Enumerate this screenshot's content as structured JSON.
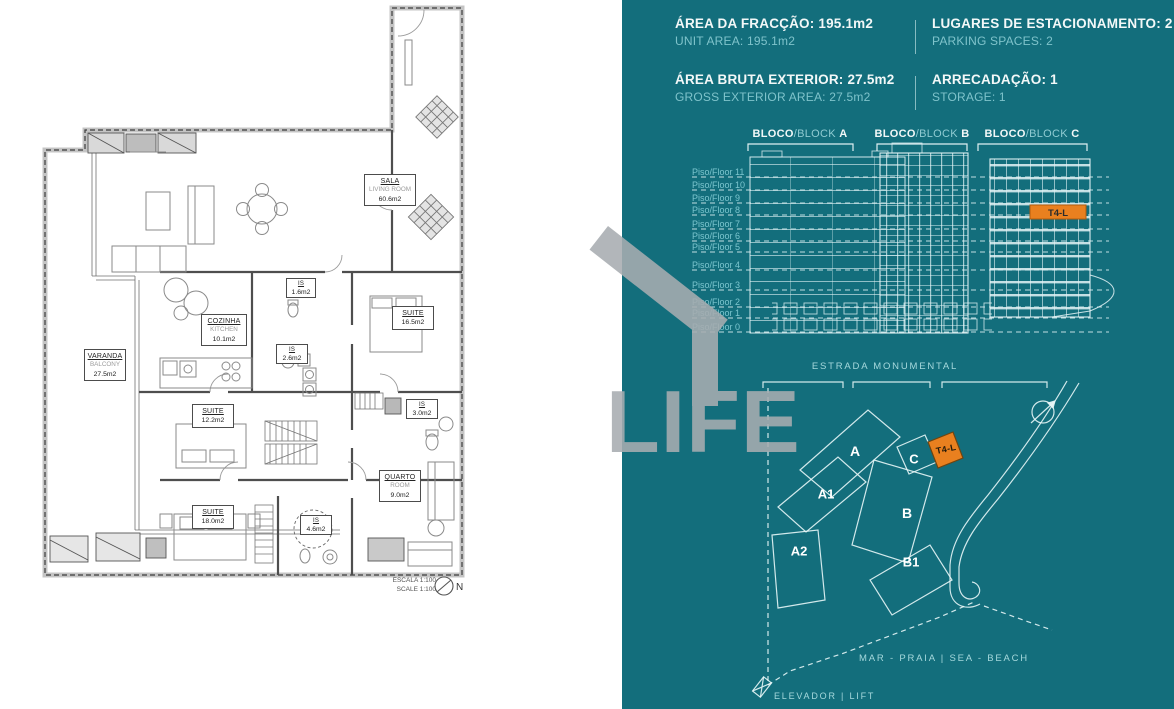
{
  "unit": "T4-L",
  "watermark": "LIFE",
  "colors": {
    "panel_teal": "#136e7c",
    "highlight_orange": "#e9801f",
    "watermark_gray": "#a8adb1",
    "line_light": "#dff0f2"
  },
  "header": {
    "col1": [
      {
        "pt": "ÁREA DA FRACÇÃO: 195.1m2",
        "en": "UNIT AREA: 195.1m2"
      },
      {
        "pt": "ÁREA BRUTA EXTERIOR: 27.5m2",
        "en": "GROSS EXTERIOR AREA: 27.5m2"
      }
    ],
    "col2": [
      {
        "pt": "LUGARES DE ESTACIONAMENTO: 2",
        "en": "PARKING SPACES: 2"
      },
      {
        "pt": "ARRECADAÇÃO: 1",
        "en": "STORAGE: 1"
      }
    ]
  },
  "elevation": {
    "blocks": [
      {
        "bold": "BLOCO",
        "light": "/BLOCK ",
        "letter": "A"
      },
      {
        "bold": "BLOCO",
        "light": "/BLOCK ",
        "letter": "B"
      },
      {
        "bold": "BLOCO",
        "light": "/BLOCK ",
        "letter": "C"
      }
    ],
    "floors": [
      "Piso/Floor 11",
      "Piso/Floor 10",
      "Piso/Floor 9",
      "Piso/Floor 8",
      "Piso/Floor 7",
      "Piso/Floor 6",
      "Piso/Floor 5",
      "Piso/Floor 4",
      "Piso/Floor 3",
      "Piso/Floor 2",
      "Piso/Floor 1",
      "Piso/Floor 0"
    ]
  },
  "site": {
    "street": "ESTRADA MONUMENTAL",
    "sea": "MAR - PRAIA | SEA - BEACH",
    "lift": "ELEVADOR | LIFT",
    "buildings": {
      "a": "A",
      "a1": "A1",
      "a2": "A2",
      "b": "B",
      "b1": "B1",
      "c": "C"
    }
  },
  "floorplan": {
    "rooms": {
      "sala": {
        "pt": "SALA",
        "en": "LIVING ROOM",
        "area": "60.6m2"
      },
      "cozinha": {
        "pt": "COZINHA",
        "en": "KITCHEN",
        "area": "10.1m2"
      },
      "varanda": {
        "pt": "VARANDA",
        "en": "BALCONY",
        "area": "27.5m2"
      },
      "quarto": {
        "pt": "QUARTO",
        "en": "ROOM",
        "area": "9.0m2"
      },
      "suite1": {
        "pt": "SUITE",
        "area": "16.5m2"
      },
      "suite2": {
        "pt": "SUITE",
        "area": "12.2m2"
      },
      "suite3": {
        "pt": "SUITE",
        "area": "18.0m2"
      },
      "is1": {
        "pt": "IS",
        "area": "1.6m2"
      },
      "is2": {
        "pt": "IS",
        "area": "2.6m2"
      },
      "is3": {
        "pt": "IS",
        "area": "3.0m2"
      },
      "is4": {
        "pt": "IS",
        "area": "4.6m2"
      }
    },
    "scale": {
      "pt": "ESCALA 1:100",
      "en": "SCALE 1:100",
      "north": "N"
    }
  }
}
